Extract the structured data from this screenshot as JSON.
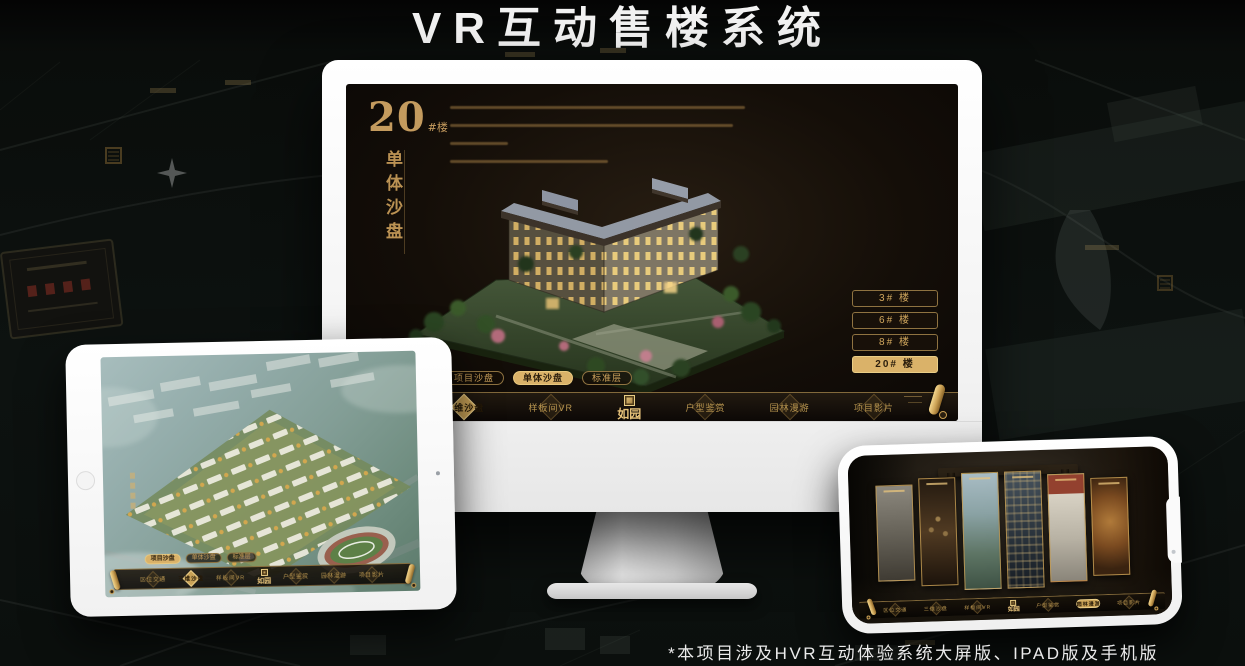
{
  "page": {
    "title": "VR互动售楼系统",
    "footnote": "*本项目涉及HVR互动体验系统大屏版、IPAD版及手机版",
    "accent_gold": "#c9a160",
    "background_color": "#0d1210",
    "title_color": "#f2f2f2"
  },
  "app": {
    "brand": "如园",
    "nav_items": [
      {
        "label": "区位交通"
      },
      {
        "label": "三维沙盘",
        "active": true
      },
      {
        "label": "样板间VR"
      },
      {
        "label": "户型鉴赏"
      },
      {
        "label": "园林漫游"
      },
      {
        "label": "项目影片"
      }
    ],
    "tabs": [
      {
        "label": "项目沙盘"
      },
      {
        "label": "单体沙盘"
      },
      {
        "label": "标准层"
      }
    ],
    "icons": {
      "scroll": "scroll-icon",
      "brand_emblem": "brand-emblem-icon",
      "nav_diamond": "diamond-emblem-icon"
    }
  },
  "monitor": {
    "heading_number": "20",
    "heading_suffix": "#楼",
    "heading_vertical": "单体沙盘",
    "active_tab": "单体沙盘",
    "floor_buttons": [
      {
        "label": "3# 楼"
      },
      {
        "label": "6# 楼"
      },
      {
        "label": "8# 楼"
      },
      {
        "label": "20# 楼",
        "active": true
      }
    ]
  },
  "ipad": {
    "active_tab": "项目沙盘"
  },
  "phone": {
    "active_nav": "园林漫游"
  }
}
